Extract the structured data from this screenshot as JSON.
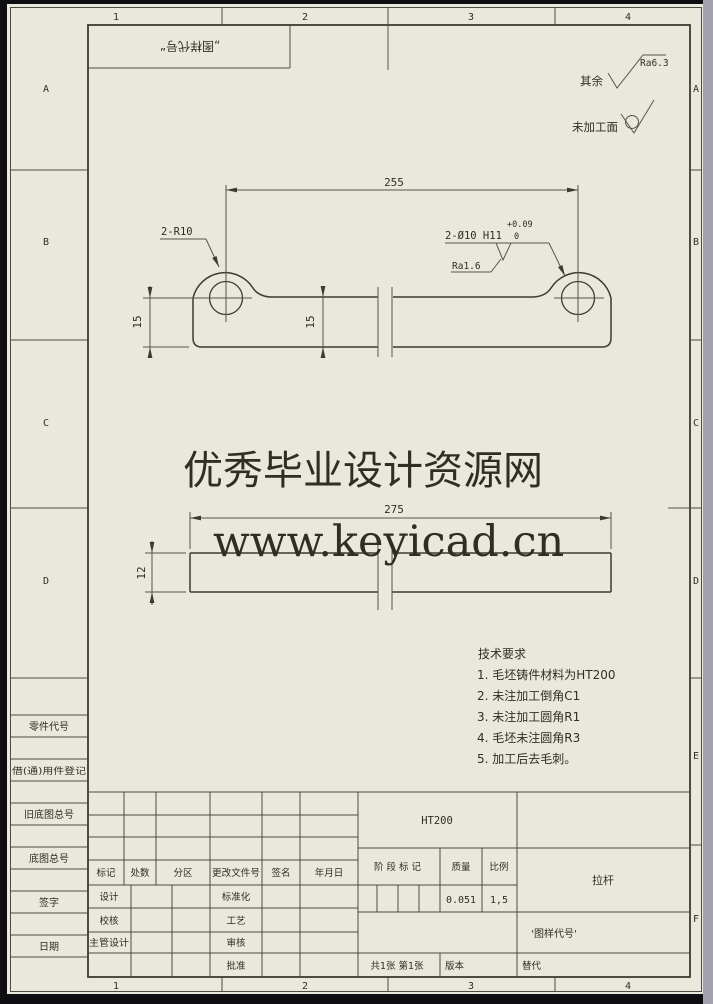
{
  "colors": {
    "paper": "#eae8dc",
    "line": "#4a4a40",
    "watermark_red": "#e6100c"
  },
  "frame": {
    "zone_numbers": [
      "1",
      "2",
      "3",
      "4"
    ],
    "zone_letters": [
      "A",
      "B",
      "C",
      "D",
      "E",
      "F"
    ],
    "top_box_label": "„图样代号“"
  },
  "finish": {
    "others_label": "其余",
    "others_value": "Ra6.3",
    "cast_label": "未加工面"
  },
  "dims": {
    "overall": "255",
    "side_overall": "275",
    "height_left": "15",
    "height_mid": "15",
    "thickness": "12",
    "fillet_note": "2-R10",
    "hole_note": "2-Ø10 H11",
    "hole_tol_upper": "+0.09",
    "hole_tol_lower": "0",
    "hole_finish": "Ra1.6"
  },
  "watermark": {
    "line1": "优秀毕业设计资源网",
    "line2": "www.keyicad.cn"
  },
  "tech": {
    "title": "技术要求",
    "items": [
      "1. 毛坯铸件材料为HT200",
      "2. 未注加工倒角C1",
      "3. 未注加工圆角R1",
      "4. 毛坯未注圆角R3",
      "5. 加工后去毛刺。"
    ]
  },
  "left_column": {
    "labels": [
      "零件代号",
      "借(通)用件登记",
      "旧底图总号",
      "底图总号",
      "签字",
      "日期"
    ]
  },
  "titleblock": {
    "rev_headers": [
      "标记",
      "处数",
      "分区",
      "更改文件号",
      "签名",
      "年月日"
    ],
    "sign_left": [
      "设计",
      "校核",
      "主管设计"
    ],
    "sign_right": [
      "标准化",
      "工艺",
      "审核",
      "批准"
    ],
    "material": "HT200",
    "stage_label": "阶段标记",
    "mass_label": "质量",
    "scale_label": "比例",
    "mass_value": "0.051",
    "scale_value": "1,5",
    "part_name": "拉杆",
    "drawing_code": "'图样代号'",
    "sheets": "共1张 第1张",
    "version_label": "版本",
    "substitute_label": "替代"
  }
}
